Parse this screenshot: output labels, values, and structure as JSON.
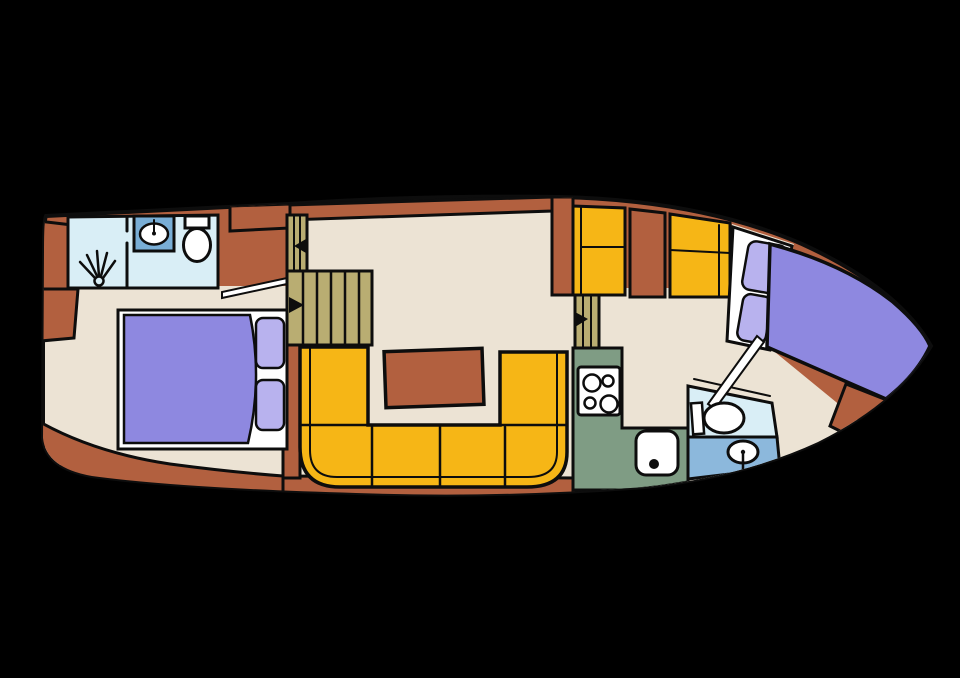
{
  "floorplan": {
    "title_semantic": "boat-interior-floor-plan",
    "canvas": {
      "width": 960,
      "height": 678,
      "background": "#000000"
    },
    "palette": {
      "hull": "#b2603f",
      "floor": "#ece3d4",
      "gold": "#f6b616",
      "khaki": "#b9ad72",
      "green": "#7f9c84",
      "lightblue": "#d9eef6",
      "medblue": "#8cb8dc",
      "sinkblue": "#79aed6",
      "purple": "#8e88e0",
      "lilac": "#b8b2ee",
      "white": "#ffffff",
      "line": "#0d0d0d"
    },
    "hull": {
      "name": "hull-outline",
      "d": "M46,216 L288,204 Q420,195 560,197 Q700,200 802,244 Q898,288 931,346 Q898,402 818,442 Q742,477 645,487 Q500,498 356,493 Q180,488 92,476 Q46,468 43,438 L44,250 Q44,220 46,216 Z",
      "stroke_width": 4
    },
    "shapes": [
      {
        "name": "aft-cabin-floor",
        "type": "polygon",
        "points": "45,286 287,286 287,480 45,464",
        "fill": "floor",
        "sw": 0
      },
      {
        "name": "salon-floor",
        "type": "polygon",
        "points": "287,212 552,204 552,295 575,295 575,480 287,480",
        "fill": "floor",
        "sw": 0
      },
      {
        "name": "forward-cabin-floor",
        "type": "path",
        "d": "M598,288 L726,288 L732,224 L794,244 L770,348 L858,420 Q800,462 718,479 Q660,489 598,488 Z",
        "fill": "floor",
        "sw": 0
      },
      {
        "name": "stern-deck-band",
        "type": "path",
        "d": "M33,418 Q90,452 170,464 Q230,472 283,476 L283,506 L30,506 Z",
        "fill": "hull",
        "sw": 3
      },
      {
        "name": "bottom-deck-band",
        "type": "path",
        "d": "M283,476 L575,478 L575,506 L283,506 Z",
        "fill": "hull",
        "sw": 3
      },
      {
        "name": "stern-locker-upper",
        "type": "polygon",
        "points": "38,221 72,225 72,289 34,289",
        "fill": "hull",
        "sw": 3
      },
      {
        "name": "stern-locker-lower",
        "type": "polygon",
        "points": "30,289 78,289 74,338 30,342",
        "fill": "hull",
        "sw": 3
      },
      {
        "name": "side-deck-strip",
        "type": "polygon",
        "points": "288,205 552,197 552,211 288,220",
        "fill": "hull",
        "sw": 3
      },
      {
        "name": "wardrobe-cabinet",
        "type": "polygon",
        "points": "230,206 290,204 290,228 230,231",
        "fill": "hull",
        "sw": 3
      },
      {
        "name": "salon-bulkhead",
        "type": "rect",
        "x": 552,
        "y": 197,
        "w": 21,
        "h": 98,
        "fill": "hull",
        "sw": 3
      },
      {
        "name": "aft-wall-strip",
        "type": "rect",
        "x": 283,
        "y": 345,
        "w": 17,
        "h": 133,
        "fill": "hull",
        "sw": 3
      },
      {
        "name": "aft-bathroom",
        "type": "polygon",
        "points": "68,217 218,215 218,288 68,288",
        "fill": "lightblue",
        "sw": 3
      },
      {
        "name": "shower-divider-wall",
        "type": "line",
        "x1": 127,
        "y1": 243,
        "x2": 127,
        "y2": 288,
        "sw": 3
      },
      {
        "name": "shower-door-stub",
        "type": "line",
        "x1": 127,
        "y1": 217,
        "x2": 127,
        "y2": 231,
        "sw": 3
      },
      {
        "name": "shower-head-icon",
        "type": "circle",
        "cx": 99,
        "cy": 281,
        "r": 4.5,
        "fill": "lightblue",
        "sw": 2.5
      },
      {
        "name": "shower-spray-ray-1",
        "type": "line",
        "x1": 95,
        "y1": 278,
        "x2": 80,
        "y2": 262,
        "sw": 2.5
      },
      {
        "name": "shower-spray-ray-2",
        "type": "line",
        "x1": 97,
        "y1": 276,
        "x2": 87,
        "y2": 255,
        "sw": 2.5
      },
      {
        "name": "shower-spray-ray-3",
        "type": "line",
        "x1": 99,
        "y1": 276,
        "x2": 97,
        "y2": 251,
        "sw": 2.5
      },
      {
        "name": "shower-spray-ray-4",
        "type": "line",
        "x1": 101,
        "y1": 276,
        "x2": 107,
        "y2": 253,
        "sw": 2.5
      },
      {
        "name": "shower-spray-ray-5",
        "type": "line",
        "x1": 103,
        "y1": 278,
        "x2": 115,
        "y2": 261,
        "sw": 2.5
      },
      {
        "name": "vanity-cabinet",
        "type": "rect",
        "x": 134,
        "y": 216,
        "w": 40,
        "h": 35,
        "fill": "sinkblue",
        "sw": 3
      },
      {
        "name": "vanity-basin",
        "type": "ellipse",
        "cx": 154,
        "cy": 234,
        "rx": 14,
        "ry": 10.5,
        "fill": "white",
        "sw": 2.5
      },
      {
        "name": "vanity-faucet",
        "type": "line",
        "x1": 154,
        "y1": 220,
        "x2": 154,
        "y2": 232,
        "sw": 2
      },
      {
        "name": "vanity-faucet-dot",
        "type": "circle",
        "cx": 154,
        "cy": 233.5,
        "r": 2,
        "fill": "line",
        "sw": 0
      },
      {
        "name": "aft-toilet-tank",
        "type": "rect",
        "x": 185,
        "y": 216,
        "w": 24,
        "h": 12,
        "fill": "white",
        "sw": 3
      },
      {
        "name": "aft-toilet-bowl",
        "type": "ellipse",
        "cx": 197,
        "cy": 245,
        "rx": 13.5,
        "ry": 16.5,
        "fill": "white",
        "sw": 3
      },
      {
        "name": "aft-cabin-door-leaf",
        "type": "polygon",
        "points": "222,298 287,284 287,278 222,292",
        "fill": "white",
        "sw": 2
      },
      {
        "name": "small-steps",
        "type": "rect",
        "x": 287,
        "y": 215,
        "w": 20,
        "h": 56,
        "fill": "khaki",
        "sw": 3
      },
      {
        "name": "small-steps-tread-1",
        "type": "line",
        "x1": 294,
        "y1": 215,
        "x2": 294,
        "y2": 271,
        "sw": 2
      },
      {
        "name": "small-steps-tread-2",
        "type": "line",
        "x1": 300,
        "y1": 215,
        "x2": 300,
        "y2": 271,
        "sw": 2
      },
      {
        "name": "small-steps-arrow-icon",
        "type": "polygon",
        "points": "306,239 306,253 294,246",
        "fill": "line",
        "sw": 0
      },
      {
        "name": "companionway-steps",
        "type": "rect",
        "x": 287,
        "y": 271,
        "w": 85,
        "h": 74,
        "fill": "khaki",
        "sw": 3
      },
      {
        "name": "companionway-tread-1",
        "type": "line",
        "x1": 303,
        "y1": 271,
        "x2": 303,
        "y2": 345,
        "sw": 2.5
      },
      {
        "name": "companionway-tread-2",
        "type": "line",
        "x1": 317,
        "y1": 271,
        "x2": 317,
        "y2": 345,
        "sw": 2.5
      },
      {
        "name": "companionway-tread-3",
        "type": "line",
        "x1": 331,
        "y1": 271,
        "x2": 331,
        "y2": 345,
        "sw": 2.5
      },
      {
        "name": "companionway-tread-4",
        "type": "line",
        "x1": 345,
        "y1": 271,
        "x2": 345,
        "y2": 345,
        "sw": 2.5
      },
      {
        "name": "companionway-tread-5",
        "type": "line",
        "x1": 359,
        "y1": 271,
        "x2": 359,
        "y2": 345,
        "sw": 2.5
      },
      {
        "name": "companionway-arrow-icon",
        "type": "polygon",
        "points": "289,297 289,313 304,305",
        "fill": "line",
        "sw": 0
      },
      {
        "name": "salon-settee",
        "type": "path",
        "d": "M300,347 L368,347 L368,425 L500,425 L500,352 L567,352 L567,452 Q567,487 527,487 L340,487 Q300,487 300,447 Z",
        "fill": "gold",
        "sw": 3.5
      },
      {
        "name": "settee-backrest-line",
        "type": "path",
        "d": "M310,347 L310,450 Q310,477 337,477 L528,477 Q557,477 557,452 L557,352",
        "fill": "none",
        "sw": 2
      },
      {
        "name": "settee-seam-left",
        "type": "line",
        "x1": 300,
        "y1": 425,
        "x2": 368,
        "y2": 425,
        "sw": 2.5
      },
      {
        "name": "settee-seam-right",
        "type": "line",
        "x1": 500,
        "y1": 425,
        "x2": 567,
        "y2": 425,
        "sw": 2.5
      },
      {
        "name": "settee-seam-c1",
        "type": "line",
        "x1": 372,
        "y1": 427,
        "x2": 372,
        "y2": 486,
        "sw": 2.5
      },
      {
        "name": "settee-seam-c2",
        "type": "line",
        "x1": 440,
        "y1": 427,
        "x2": 440,
        "y2": 487,
        "sw": 2.5
      },
      {
        "name": "settee-seam-c3",
        "type": "line",
        "x1": 505,
        "y1": 427,
        "x2": 505,
        "y2": 486,
        "sw": 2.5
      },
      {
        "name": "salon-table",
        "type": "rect",
        "x": 385,
        "y": 350,
        "w": 98,
        "h": 56,
        "fill": "hull",
        "sw": 3.5,
        "rot": "-2 434 378"
      },
      {
        "name": "galley-steps",
        "type": "rect",
        "x": 575,
        "y": 292,
        "w": 24,
        "h": 58,
        "fill": "khaki",
        "sw": 3
      },
      {
        "name": "galley-steps-tread-1",
        "type": "line",
        "x1": 583,
        "y1": 292,
        "x2": 583,
        "y2": 350,
        "sw": 2
      },
      {
        "name": "galley-steps-tread-2",
        "type": "line",
        "x1": 591,
        "y1": 292,
        "x2": 591,
        "y2": 350,
        "sw": 2
      },
      {
        "name": "galley-steps-arrow-icon",
        "type": "polygon",
        "points": "575,312 575,327 588,319",
        "fill": "line",
        "sw": 0
      },
      {
        "name": "galley-cabinet-a",
        "type": "polygon",
        "points": "573,206 625,208 625,295 573,295",
        "fill": "gold",
        "sw": 3
      },
      {
        "name": "galley-cabinet-a-div1",
        "type": "line",
        "x1": 581,
        "y1": 206,
        "x2": 581,
        "y2": 295,
        "sw": 2
      },
      {
        "name": "galley-cabinet-a-div2",
        "type": "line",
        "x1": 581,
        "y1": 247,
        "x2": 625,
        "y2": 247,
        "sw": 2
      },
      {
        "name": "galley-cabinet-mid",
        "type": "polygon",
        "points": "630,209 665,213 665,297 630,297",
        "fill": "hull",
        "sw": 3
      },
      {
        "name": "galley-cabinet-b",
        "type": "polygon",
        "points": "670,214 730,223 730,297 670,297",
        "fill": "gold",
        "sw": 3
      },
      {
        "name": "galley-cabinet-b-div1",
        "type": "line",
        "x1": 670,
        "y1": 250,
        "x2": 730,
        "y2": 253,
        "sw": 2
      },
      {
        "name": "galley-cabinet-b-div2",
        "type": "line",
        "x1": 719,
        "y1": 225,
        "x2": 719,
        "y2": 297,
        "sw": 2
      },
      {
        "name": "vberth-seat-frame",
        "type": "polygon",
        "points": "733,227 792,246 770,350 727,341",
        "fill": "white",
        "sw": 3
      },
      {
        "name": "vberth-pillow-1",
        "type": "rect",
        "x": 745,
        "y": 243,
        "w": 39,
        "h": 49,
        "rx": 8,
        "fill": "lilac",
        "sw": 2.5,
        "rot": "10 764 267"
      },
      {
        "name": "vberth-pillow-2",
        "type": "rect",
        "x": 740,
        "y": 295,
        "w": 29,
        "h": 47,
        "rx": 8,
        "fill": "lilac",
        "sw": 2.5,
        "rot": "10 754 318"
      },
      {
        "name": "vberth-bed",
        "type": "path",
        "d": "M770,244 Q845,264 893,302 Q922,327 930,346 Q918,372 892,394 L886,399 L767,347 Z",
        "fill": "purple",
        "sw": 3.5
      },
      {
        "name": "bow-deck-triangle",
        "type": "polygon",
        "points": "846,384 892,402 858,440 830,426",
        "fill": "hull",
        "sw": 3
      },
      {
        "name": "fwd-bathroom-upper",
        "type": "polygon",
        "points": "688,386 772,403 777,437 688,437",
        "fill": "lightblue",
        "sw": 3
      },
      {
        "name": "fwd-bathroom-floor",
        "type": "polygon",
        "points": "688,437 777,437 780,468 688,479",
        "fill": "medblue",
        "sw": 3
      },
      {
        "name": "fwd-bath-counter-line",
        "type": "line",
        "x1": 694,
        "y1": 379,
        "x2": 770,
        "y2": 396,
        "sw": 2
      },
      {
        "name": "fwd-door-leaf",
        "type": "polygon",
        "points": "708,404 757,336 764,342 715,409",
        "fill": "white",
        "sw": 2
      },
      {
        "name": "fwd-toilet-tank",
        "type": "rect",
        "x": 692,
        "y": 403,
        "w": 11,
        "h": 31,
        "fill": "white",
        "sw": 2.5,
        "rot": "-4 697 418"
      },
      {
        "name": "fwd-toilet-bowl",
        "type": "ellipse",
        "cx": 724,
        "cy": 418,
        "rx": 20,
        "ry": 15,
        "fill": "white",
        "sw": 3
      },
      {
        "name": "fwd-basin",
        "type": "ellipse",
        "cx": 743,
        "cy": 452,
        "rx": 15,
        "ry": 11,
        "fill": "white",
        "sw": 3
      },
      {
        "name": "fwd-basin-faucet",
        "type": "line",
        "x1": 743,
        "y1": 453,
        "x2": 743,
        "y2": 469,
        "sw": 2.5
      },
      {
        "name": "fwd-basin-dot",
        "type": "circle",
        "cx": 743,
        "cy": 452,
        "r": 2.2,
        "fill": "line",
        "sw": 0
      },
      {
        "name": "galley-counter",
        "type": "path",
        "d": "M573,348 L622,348 L622,428 L688,428 L688,482 Q648,489 622,490 L573,490 Z",
        "fill": "green",
        "sw": 3
      },
      {
        "name": "stove",
        "type": "rect",
        "x": 578,
        "y": 367,
        "w": 42,
        "h": 48,
        "rx": 3,
        "fill": "white",
        "sw": 3
      },
      {
        "name": "stove-burner-1",
        "type": "circle",
        "cx": 592,
        "cy": 383,
        "r": 8.5,
        "fill": "white",
        "sw": 2.5
      },
      {
        "name": "stove-burner-2",
        "type": "circle",
        "cx": 608,
        "cy": 381,
        "r": 5.5,
        "fill": "white",
        "sw": 2.5
      },
      {
        "name": "stove-burner-3",
        "type": "circle",
        "cx": 590,
        "cy": 403,
        "r": 5.5,
        "fill": "white",
        "sw": 2.5
      },
      {
        "name": "stove-burner-4",
        "type": "circle",
        "cx": 609,
        "cy": 404,
        "r": 8.5,
        "fill": "white",
        "sw": 2.5
      },
      {
        "name": "galley-sink",
        "type": "rect",
        "x": 636,
        "y": 431,
        "w": 42,
        "h": 44,
        "rx": 10,
        "fill": "white",
        "sw": 3
      },
      {
        "name": "galley-sink-drain",
        "type": "circle",
        "cx": 654,
        "cy": 464,
        "r": 5,
        "fill": "line",
        "sw": 0
      },
      {
        "name": "aft-bed-frame",
        "type": "rect",
        "x": 118,
        "y": 310,
        "w": 169,
        "h": 139,
        "fill": "white",
        "sw": 3
      },
      {
        "name": "aft-bed-mattress",
        "type": "path",
        "d": "M124,315 L250,315 Q263,379 248,443 L124,443 Z",
        "fill": "purple",
        "sw": 2.5
      },
      {
        "name": "aft-bed-pillow-1",
        "type": "rect",
        "x": 256,
        "y": 318,
        "w": 28,
        "h": 50,
        "rx": 7,
        "fill": "lilac",
        "sw": 2.5
      },
      {
        "name": "aft-bed-pillow-2",
        "type": "rect",
        "x": 256,
        "y": 380,
        "w": 28,
        "h": 50,
        "rx": 7,
        "fill": "lilac",
        "sw": 2.5
      }
    ]
  }
}
